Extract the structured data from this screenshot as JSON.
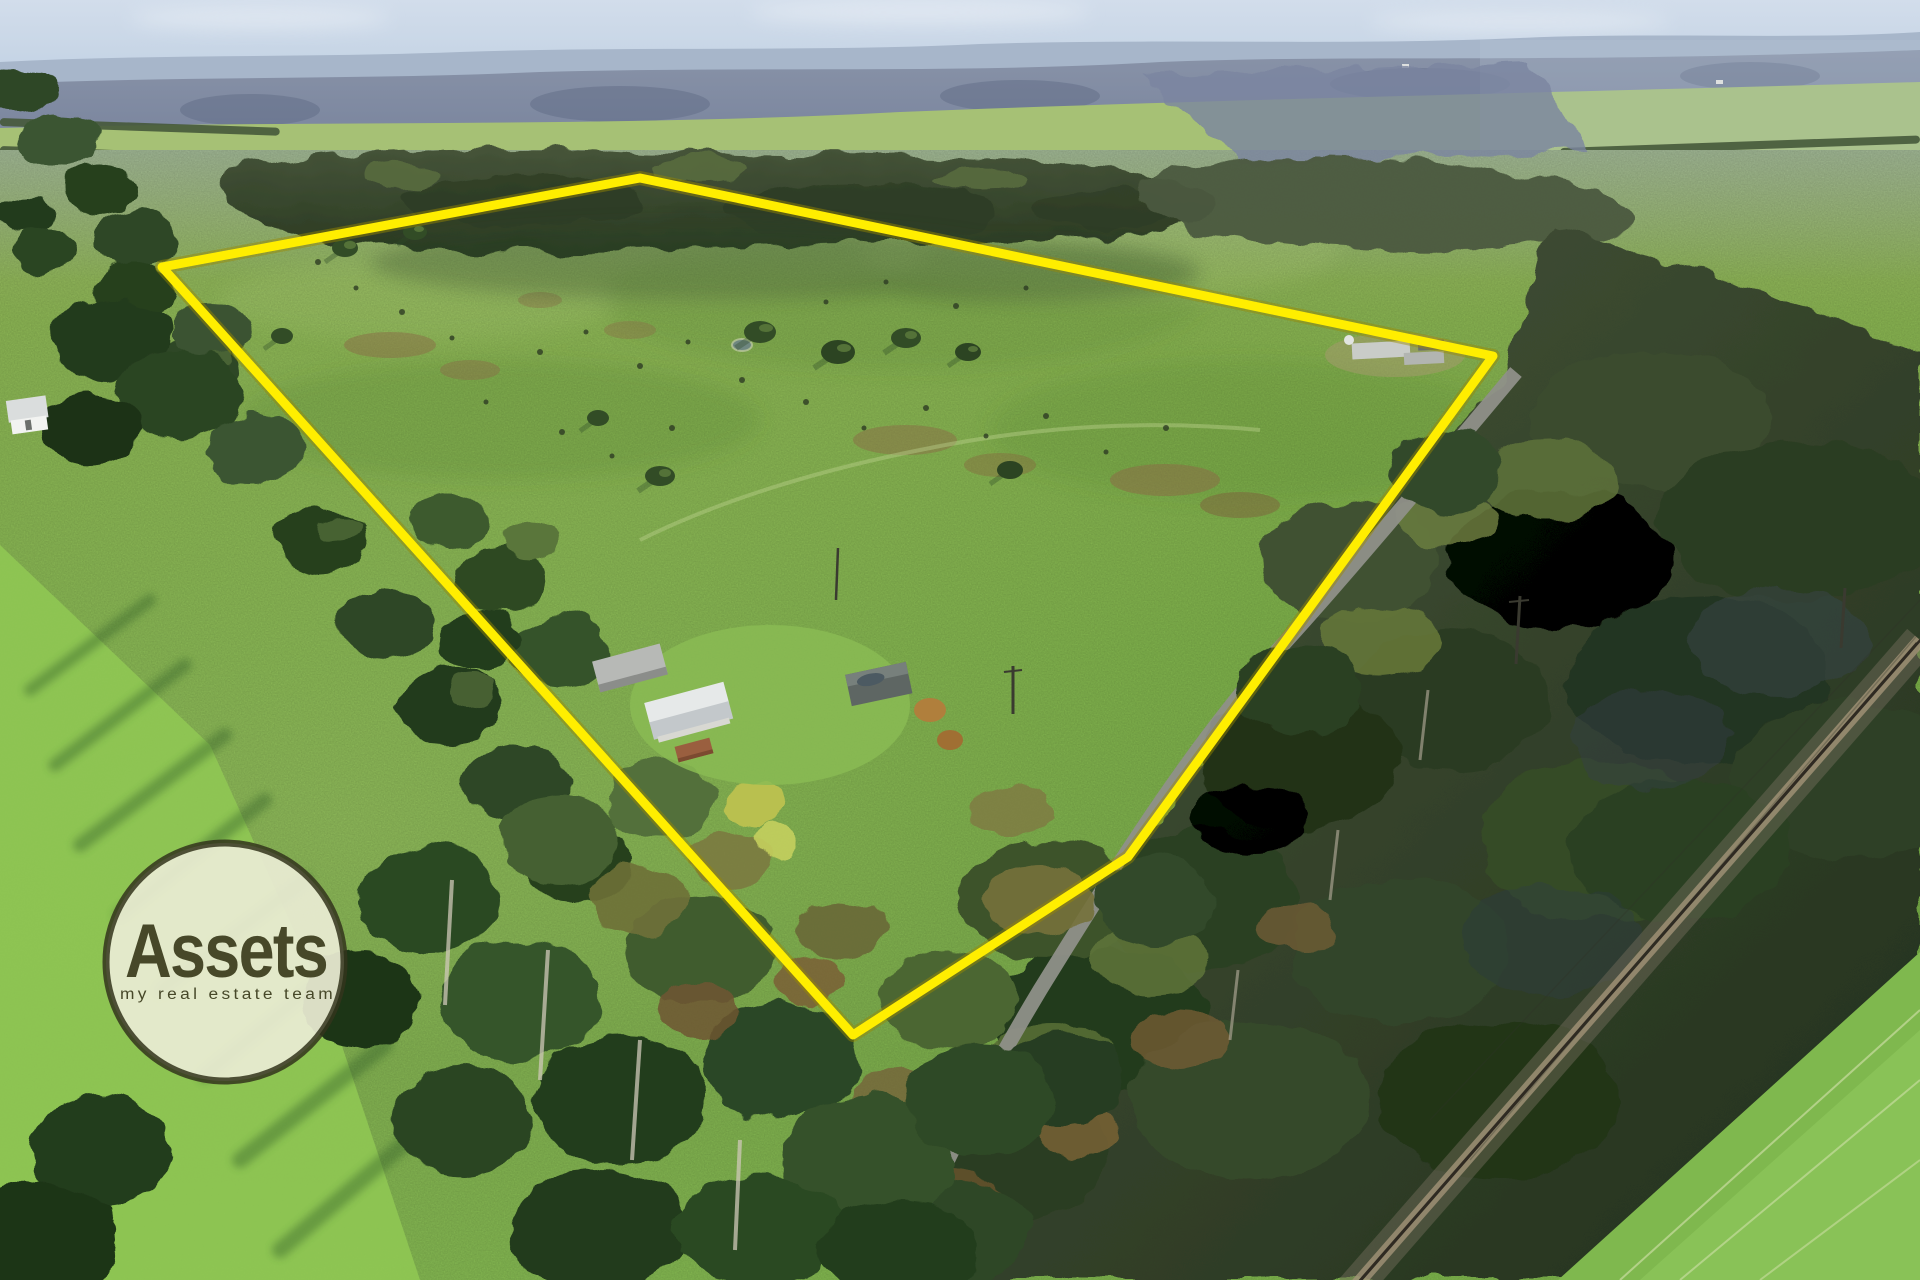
{
  "meta": {
    "description": "Aerial drone photograph of a rural grazing property outlined in yellow, with homestead, sheds, shelterbelt trees, country road, railway corridor and hazy forested horizon; Assets real estate watermark in lower left",
    "width": 1920,
    "height": 1280
  },
  "watermark": {
    "brand": "Assets",
    "tagline": "my real estate team",
    "circle_fill": "#e9ecd3",
    "border_color": "#33341c",
    "text_color": "#474829"
  },
  "boundary": {
    "label": "property-boundary-overlay",
    "color": "#ffee00",
    "halo_color": "#9c8a00",
    "stroke_width": 9,
    "points": "162,267 640,178 1493,356 1128,857 853,1035"
  },
  "palette": {
    "sky": "#c8d6e8",
    "distant_ridge": "#a7b6ca",
    "haze_forest": "#7e88a0",
    "distant_field": "#a6c175",
    "pasture": "#7fb74a",
    "sunlit_field": "#8fc653",
    "forest_dark": "#2c3e24",
    "forest_light": "#5d7038",
    "road": "#8f9089",
    "rail_ballast": "#a39478",
    "marsh": "#8a6b46",
    "roof_silver": "#e6e9e9",
    "roof_gray": "#b7b9b6",
    "roof_rust": "#9a5f3f"
  }
}
